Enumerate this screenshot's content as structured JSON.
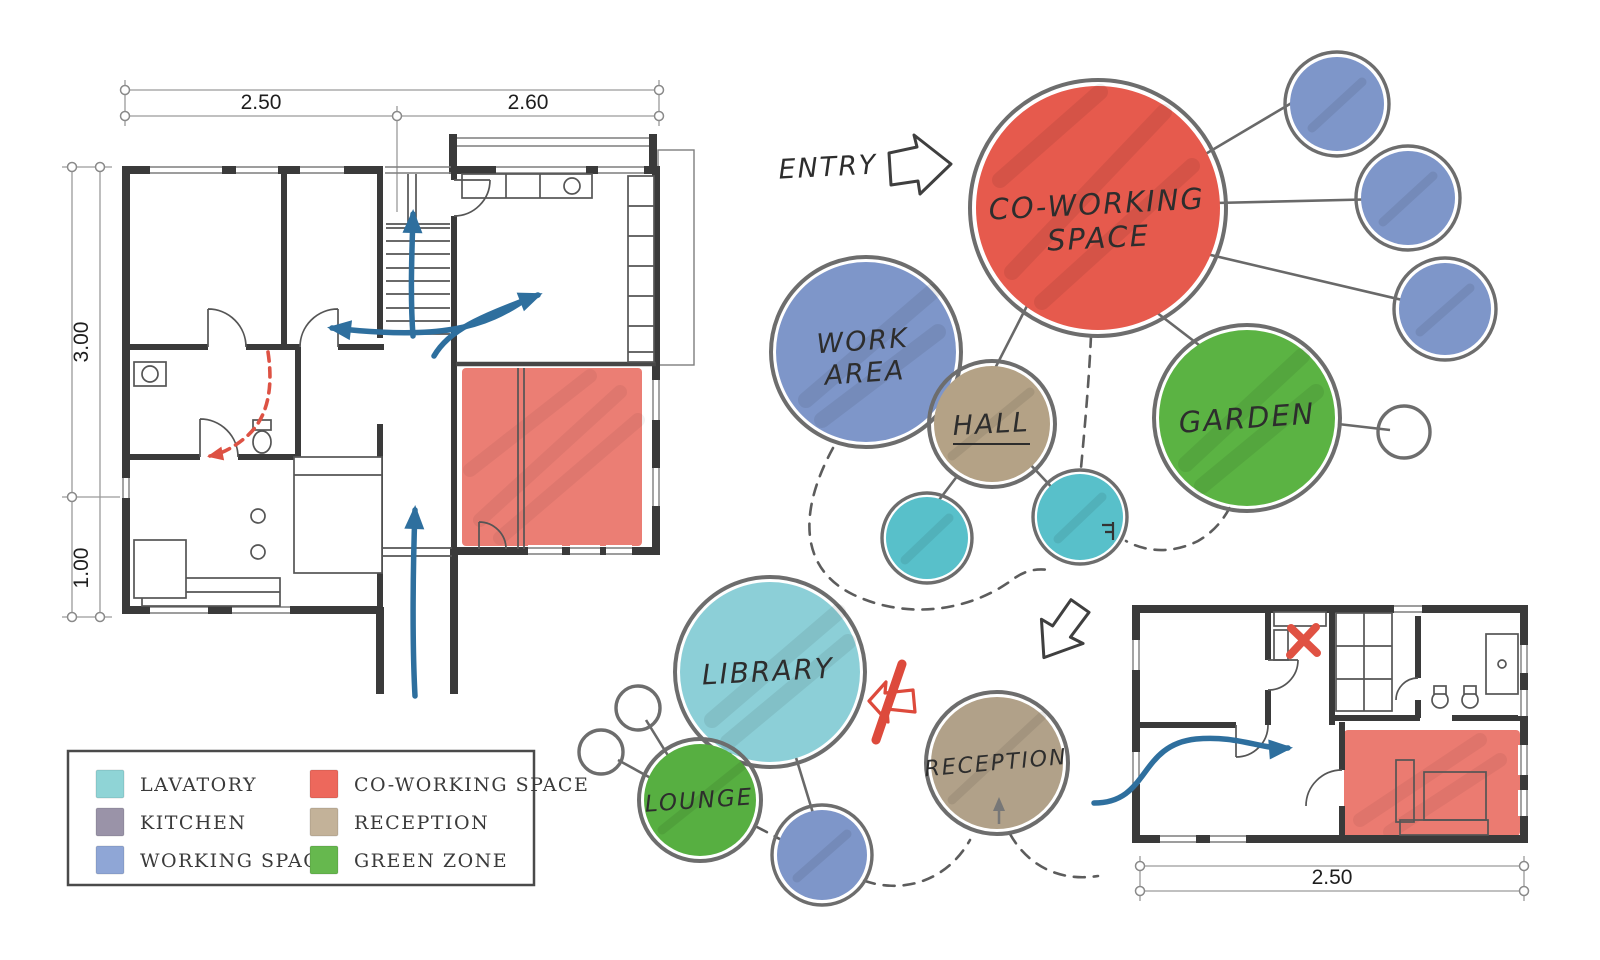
{
  "title": "Co-working space concept sketch",
  "colors": {
    "co_working": "#e65a4d",
    "working_space": "#7e96c9",
    "hall": "#b4a286",
    "reception": "#b1a189",
    "garden": "#5bb343",
    "lounge": "#57af41",
    "lavatory": "#58c0ca",
    "library": "#8ccfd7",
    "kitchen": "#9a93a8",
    "wall": "#3a3a3a",
    "flow_arrow": "#2e6f9e",
    "alert_red": "#e05243",
    "outline_gray": "#6d6d6d"
  },
  "entry": {
    "label": "ENTRY"
  },
  "bubbles": {
    "co_working": {
      "label": "CO-WORKING SPACE",
      "line1": "CO-WORKING",
      "line2": "SPACE"
    },
    "work_area": {
      "label": "WORK AREA",
      "line1": "WORK",
      "line2": "AREA"
    },
    "hall": {
      "label": "HALL"
    },
    "garden": {
      "label": "GARDEN"
    },
    "library": {
      "label": "LIBRARY"
    },
    "lounge": {
      "label": "LOUNGE"
    },
    "reception": {
      "label": "RECEPTION"
    }
  },
  "dimensions": {
    "main_plan": {
      "top_left": "2.50",
      "top_right": "2.60",
      "left_upper": "3.00",
      "left_lower": "1.00"
    },
    "small_plan": {
      "bottom": "2.50"
    }
  },
  "legend": {
    "items": [
      {
        "label": "LAVATORY",
        "color": "#8fd4d6"
      },
      {
        "label": "KITCHEN",
        "color": "#9a93a8"
      },
      {
        "label": "WORKING SPACE",
        "color": "#8fa6d6"
      },
      {
        "label": "CO-WORKING SPACE",
        "color": "#ed685c"
      },
      {
        "label": "RECEPTION",
        "color": "#c3b299"
      },
      {
        "label": "GREEN ZONE",
        "color": "#66b84e"
      }
    ]
  },
  "annotations": {
    "corner_mark": "F"
  }
}
